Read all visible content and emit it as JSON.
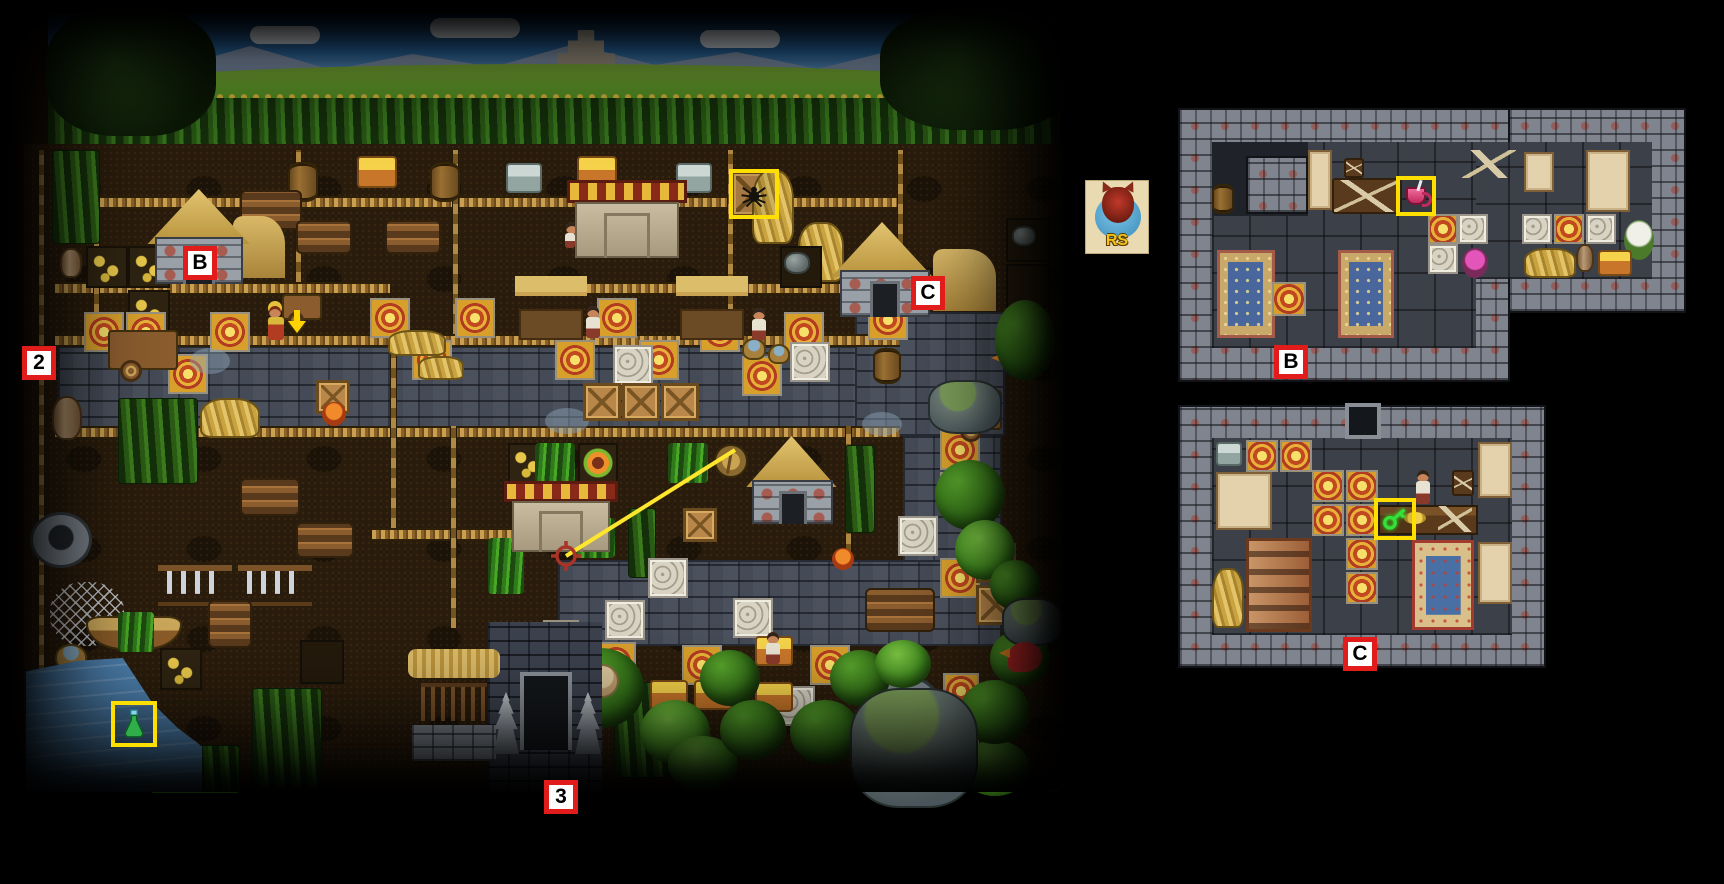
{
  "scene": {
    "type": "game-walkthrough-map",
    "description": "Aztec village level map with background mountains, corn fields, stone roads, lake, jungle, and two interior room insets"
  },
  "markers": {
    "m2": {
      "label": "2"
    },
    "mB": {
      "label": "B"
    },
    "mC": {
      "label": "C"
    },
    "m3": {
      "label": "3"
    },
    "roomB": {
      "label": "B"
    },
    "roomC": {
      "label": "C"
    }
  },
  "highlights": {
    "spider": {
      "item": "spider-on-crate"
    },
    "potion": {
      "item": "green-potion-flask"
    },
    "cup": {
      "item": "pink-mug-on-table"
    },
    "key": {
      "item": "green-key-on-counter"
    }
  },
  "annotations": {
    "arrow": "yellow-down-arrow-over-chief",
    "sight_line": "yellow-line-from-dagger-shield-to-red-crosshair"
  },
  "watermark": {
    "text": "RS"
  },
  "colors": {
    "marker_border": "#e21b1b",
    "marker_bg": "#ffffff",
    "marker_text": "#000000",
    "highlight_yellow": "#ffdf00",
    "sight_line_yellow": "#ffe62e",
    "crosshair_red": "#a83326",
    "water_blue": "#4d80ae",
    "road_gray": "#444a56",
    "dirt_brown": "#2a1c0c",
    "room_wall_gray": "#7f848e"
  }
}
